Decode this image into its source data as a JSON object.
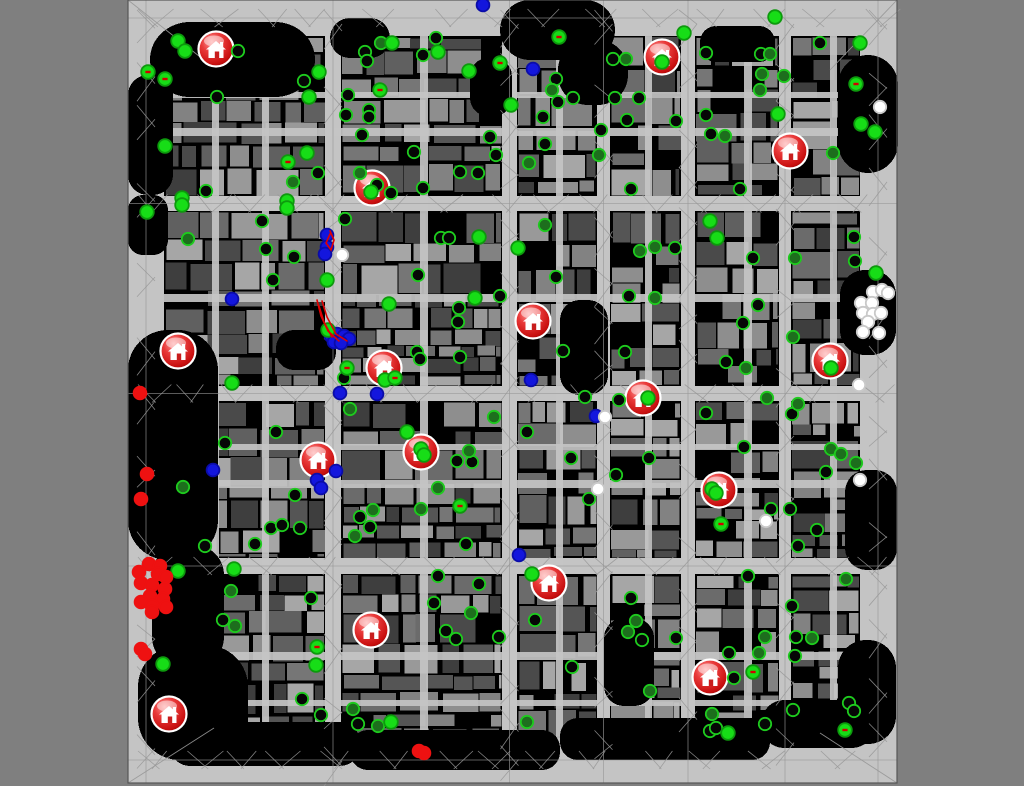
{
  "window": {
    "kind": "rescue-simulation-map-viewer",
    "background_color": "#7f7f7f"
  },
  "map": {
    "x": 128,
    "y": 0,
    "width": 769,
    "height": 783,
    "road_color": "#c4c4c4",
    "mesh_line_color": "#989898",
    "border_line_color": "#565656",
    "block_base_color": "#000000",
    "building_shades": [
      "#3e3e3e",
      "#4a4a4a",
      "#555555",
      "#606060",
      "#6b6b6b",
      "#767676",
      "#828282",
      "#8e8e8e",
      "#999999",
      "#a6a6a6"
    ],
    "seed": 1337,
    "ring": {
      "left_w": 36,
      "right_x": 860,
      "right_w": 37,
      "top_h": 36,
      "bottom_y": 738,
      "bottom_h": 45
    },
    "v_streets": [
      {
        "x": 325,
        "w": 16
      },
      {
        "x": 502,
        "w": 15
      },
      {
        "x": 597,
        "w": 13
      },
      {
        "x": 681,
        "w": 14
      },
      {
        "x": 779,
        "w": 12
      }
    ],
    "h_streets": [
      {
        "y": 196,
        "h": 15
      },
      {
        "y": 386,
        "h": 15
      },
      {
        "y": 558,
        "h": 16
      }
    ],
    "v_lanes": [
      {
        "x": 212,
        "w": 7
      },
      {
        "x": 262,
        "w": 7
      },
      {
        "x": 420,
        "w": 8
      },
      {
        "x": 556,
        "w": 7
      },
      {
        "x": 645,
        "w": 7
      },
      {
        "x": 744,
        "w": 8
      },
      {
        "x": 830,
        "w": 7
      }
    ],
    "h_lanes": [
      {
        "y": 92,
        "h": 6
      },
      {
        "y": 128,
        "h": 8
      },
      {
        "y": 294,
        "h": 8
      },
      {
        "y": 444,
        "h": 6
      },
      {
        "y": 480,
        "h": 8
      },
      {
        "y": 652,
        "h": 8
      },
      {
        "y": 700,
        "h": 6
      }
    ],
    "dark_areas": [
      [
        150,
        22,
        165,
        75,
        40
      ],
      [
        330,
        18,
        60,
        40,
        20
      ],
      [
        500,
        0,
        115,
        60,
        30
      ],
      [
        558,
        40,
        70,
        65,
        30
      ],
      [
        700,
        26,
        75,
        36,
        16
      ],
      [
        838,
        55,
        60,
        118,
        30
      ],
      [
        128,
        75,
        45,
        120,
        20
      ],
      [
        128,
        195,
        40,
        60,
        15
      ],
      [
        128,
        330,
        90,
        230,
        40
      ],
      [
        152,
        545,
        72,
        122,
        30
      ],
      [
        138,
        645,
        110,
        115,
        42
      ],
      [
        170,
        722,
        190,
        44,
        20
      ],
      [
        350,
        730,
        210,
        40,
        18
      ],
      [
        560,
        718,
        210,
        42,
        18
      ],
      [
        762,
        700,
        112,
        48,
        22
      ],
      [
        560,
        300,
        48,
        95,
        20
      ],
      [
        604,
        618,
        50,
        88,
        20
      ],
      [
        840,
        270,
        56,
        85,
        25
      ],
      [
        845,
        470,
        52,
        100,
        22
      ],
      [
        838,
        640,
        58,
        104,
        28
      ],
      [
        470,
        58,
        42,
        58,
        18
      ],
      [
        276,
        330,
        60,
        40,
        18
      ]
    ]
  },
  "legend": {
    "civilian_bright_fill": "#17dd17",
    "civilian_bright_ring": "#0d9a0d",
    "civilian_mid_fill": "#1d6e1d",
    "civilian_dark_fill": "#060606",
    "civilian_ring": "#1ecb1e",
    "police_fill": "#1316dd",
    "police_ring": "#0a0ca8",
    "ambulance_fill": "#ffffff",
    "ambulance_ring": "#c9c9c9",
    "fire_brigade_fill": "#ee1111",
    "refuge_body": "#d42222",
    "refuge_dark": "#7a0000",
    "refuge_glyph": "#ffffff",
    "hose_color": "#e00000",
    "injury_tick_color": "#d40000"
  },
  "entities": {
    "refuges": [
      [
        216,
        49
      ],
      [
        662,
        57
      ],
      [
        790,
        151
      ],
      [
        372,
        188
      ],
      [
        178,
        351
      ],
      [
        533,
        321
      ],
      [
        384,
        368
      ],
      [
        643,
        398
      ],
      [
        830,
        361
      ],
      [
        318,
        460
      ],
      [
        421,
        452
      ],
      [
        719,
        490
      ],
      [
        549,
        583
      ],
      [
        371,
        630
      ],
      [
        710,
        677
      ],
      [
        169,
        714
      ]
    ],
    "civilians_bright": [
      [
        178,
        41
      ],
      [
        185,
        51
      ],
      [
        148,
        72,
        1
      ],
      [
        165,
        79,
        1
      ],
      [
        319,
        72
      ],
      [
        309,
        97
      ],
      [
        380,
        90,
        1
      ],
      [
        392,
        43
      ],
      [
        438,
        52
      ],
      [
        469,
        71
      ],
      [
        500,
        63,
        1
      ],
      [
        511,
        105
      ],
      [
        165,
        146
      ],
      [
        182,
        198
      ],
      [
        182,
        205
      ],
      [
        147,
        212
      ],
      [
        287,
        201
      ],
      [
        287,
        208
      ],
      [
        307,
        153
      ],
      [
        288,
        162,
        1
      ],
      [
        371,
        192
      ],
      [
        327,
        280
      ],
      [
        479,
        237
      ],
      [
        475,
        298
      ],
      [
        389,
        304
      ],
      [
        328,
        330
      ],
      [
        385,
        380
      ],
      [
        395,
        378,
        1
      ],
      [
        232,
        383
      ],
      [
        347,
        368,
        1
      ],
      [
        559,
        37,
        1
      ],
      [
        684,
        33
      ],
      [
        775,
        17
      ],
      [
        662,
        62
      ],
      [
        860,
        43
      ],
      [
        856,
        84,
        1
      ],
      [
        875,
        132
      ],
      [
        861,
        124
      ],
      [
        778,
        114
      ],
      [
        876,
        273
      ],
      [
        518,
        248
      ],
      [
        710,
        221
      ],
      [
        717,
        238
      ],
      [
        831,
        368
      ],
      [
        648,
        398
      ],
      [
        712,
        489
      ],
      [
        716,
        493
      ],
      [
        421,
        449
      ],
      [
        424,
        455
      ],
      [
        532,
        574
      ],
      [
        728,
        733
      ],
      [
        753,
        672,
        1
      ],
      [
        845,
        730,
        1
      ],
      [
        163,
        664
      ],
      [
        178,
        571
      ],
      [
        234,
        569
      ],
      [
        317,
        647,
        1
      ],
      [
        316,
        665
      ],
      [
        391,
        722
      ],
      [
        407,
        432
      ],
      [
        460,
        506,
        1
      ],
      [
        721,
        524,
        1
      ]
    ],
    "civilians_mid": [
      [
        381,
        43
      ],
      [
        293,
        182
      ],
      [
        360,
        173
      ],
      [
        188,
        239
      ],
      [
        552,
        90
      ],
      [
        626,
        59
      ],
      [
        770,
        54
      ],
      [
        762,
        74
      ],
      [
        784,
        76
      ],
      [
        760,
        90
      ],
      [
        599,
        155
      ],
      [
        529,
        163
      ],
      [
        725,
        136
      ],
      [
        833,
        153
      ],
      [
        545,
        225
      ],
      [
        640,
        251
      ],
      [
        655,
        247
      ],
      [
        795,
        258
      ],
      [
        655,
        298
      ],
      [
        793,
        337
      ],
      [
        746,
        368
      ],
      [
        350,
        409
      ],
      [
        494,
        417
      ],
      [
        183,
        487
      ],
      [
        469,
        451
      ],
      [
        438,
        488
      ],
      [
        421,
        509
      ],
      [
        373,
        510
      ],
      [
        355,
        536
      ],
      [
        231,
        591
      ],
      [
        235,
        626
      ],
      [
        353,
        709
      ],
      [
        378,
        726
      ],
      [
        471,
        613
      ],
      [
        767,
        398
      ],
      [
        798,
        404
      ],
      [
        831,
        449
      ],
      [
        841,
        454
      ],
      [
        856,
        463
      ],
      [
        846,
        579
      ],
      [
        636,
        621
      ],
      [
        628,
        632
      ],
      [
        765,
        637
      ],
      [
        812,
        638
      ],
      [
        759,
        653
      ],
      [
        650,
        691
      ],
      [
        527,
        722
      ],
      [
        712,
        714
      ]
    ],
    "civilians_dark": [
      [
        238,
        51
      ],
      [
        304,
        81
      ],
      [
        217,
        97
      ],
      [
        348,
        95
      ],
      [
        365,
        52
      ],
      [
        436,
        38
      ],
      [
        423,
        55
      ],
      [
        367,
        61
      ],
      [
        346,
        115
      ],
      [
        369,
        110
      ],
      [
        369,
        117
      ],
      [
        362,
        135
      ],
      [
        414,
        152
      ],
      [
        490,
        137
      ],
      [
        496,
        155
      ],
      [
        460,
        172
      ],
      [
        478,
        173
      ],
      [
        206,
        191
      ],
      [
        262,
        221
      ],
      [
        318,
        173
      ],
      [
        377,
        185
      ],
      [
        391,
        193
      ],
      [
        423,
        188
      ],
      [
        266,
        249
      ],
      [
        294,
        257
      ],
      [
        273,
        280
      ],
      [
        345,
        219
      ],
      [
        441,
        238
      ],
      [
        449,
        238
      ],
      [
        418,
        275
      ],
      [
        459,
        308
      ],
      [
        458,
        322
      ],
      [
        500,
        296
      ],
      [
        417,
        352
      ],
      [
        460,
        357
      ],
      [
        420,
        359
      ],
      [
        344,
        378
      ],
      [
        556,
        79
      ],
      [
        558,
        102
      ],
      [
        573,
        98
      ],
      [
        615,
        98
      ],
      [
        639,
        98
      ],
      [
        613,
        59
      ],
      [
        706,
        53
      ],
      [
        761,
        54
      ],
      [
        820,
        43
      ],
      [
        543,
        117
      ],
      [
        545,
        144
      ],
      [
        601,
        130
      ],
      [
        627,
        120
      ],
      [
        676,
        121
      ],
      [
        631,
        189
      ],
      [
        740,
        189
      ],
      [
        706,
        115
      ],
      [
        711,
        134
      ],
      [
        675,
        248
      ],
      [
        556,
        277
      ],
      [
        753,
        258
      ],
      [
        854,
        237
      ],
      [
        855,
        261
      ],
      [
        629,
        296
      ],
      [
        758,
        305
      ],
      [
        743,
        323
      ],
      [
        726,
        362
      ],
      [
        563,
        351
      ],
      [
        625,
        352
      ],
      [
        276,
        432
      ],
      [
        225,
        443
      ],
      [
        295,
        495
      ],
      [
        457,
        461
      ],
      [
        472,
        462
      ],
      [
        360,
        517
      ],
      [
        370,
        527
      ],
      [
        271,
        528
      ],
      [
        282,
        525
      ],
      [
        300,
        528
      ],
      [
        255,
        544
      ],
      [
        205,
        546
      ],
      [
        466,
        544
      ],
      [
        223,
        620
      ],
      [
        311,
        598
      ],
      [
        302,
        699
      ],
      [
        321,
        715
      ],
      [
        358,
        724
      ],
      [
        438,
        576
      ],
      [
        479,
        584
      ],
      [
        434,
        603
      ],
      [
        446,
        631
      ],
      [
        456,
        639
      ],
      [
        499,
        637
      ],
      [
        585,
        397
      ],
      [
        619,
        400
      ],
      [
        706,
        413
      ],
      [
        792,
        414
      ],
      [
        527,
        432
      ],
      [
        571,
        458
      ],
      [
        616,
        475
      ],
      [
        649,
        458
      ],
      [
        589,
        499
      ],
      [
        744,
        447
      ],
      [
        826,
        472
      ],
      [
        771,
        509
      ],
      [
        790,
        509
      ],
      [
        817,
        530
      ],
      [
        798,
        546
      ],
      [
        748,
        576
      ],
      [
        631,
        598
      ],
      [
        642,
        640
      ],
      [
        676,
        638
      ],
      [
        535,
        620
      ],
      [
        792,
        606
      ],
      [
        796,
        637
      ],
      [
        729,
        653
      ],
      [
        795,
        656
      ],
      [
        572,
        667
      ],
      [
        734,
        678
      ],
      [
        710,
        731
      ],
      [
        716,
        728
      ],
      [
        765,
        724
      ],
      [
        793,
        710
      ],
      [
        849,
        703
      ],
      [
        854,
        711
      ]
    ],
    "police": [
      [
        483,
        5
      ],
      [
        533,
        69
      ],
      [
        232,
        299
      ],
      [
        327,
        235
      ],
      [
        327,
        247
      ],
      [
        325,
        254
      ],
      [
        213,
        470
      ],
      [
        317,
        480
      ],
      [
        321,
        488
      ],
      [
        336,
        471
      ],
      [
        340,
        393
      ],
      [
        377,
        394
      ],
      [
        531,
        380
      ],
      [
        519,
        555
      ],
      [
        596,
        416
      ],
      [
        331,
        336
      ],
      [
        337,
        334
      ],
      [
        344,
        336
      ],
      [
        349,
        339
      ],
      [
        334,
        342
      ],
      [
        341,
        343
      ]
    ],
    "ambulances": [
      [
        342,
        255
      ],
      [
        605,
        417
      ],
      [
        598,
        489
      ],
      [
        766,
        521
      ],
      [
        860,
        480
      ],
      [
        880,
        107
      ],
      [
        873,
        292
      ],
      [
        882,
        290
      ],
      [
        888,
        293
      ],
      [
        861,
        303
      ],
      [
        872,
        303
      ],
      [
        863,
        313
      ],
      [
        873,
        314
      ],
      [
        881,
        313
      ],
      [
        868,
        322
      ],
      [
        863,
        332
      ],
      [
        879,
        333
      ],
      [
        859,
        385
      ]
    ],
    "fire_brigades": [
      [
        140,
        393
      ],
      [
        147,
        474
      ],
      [
        141,
        499
      ],
      [
        141,
        649
      ],
      [
        145,
        654
      ],
      [
        149,
        564
      ],
      [
        160,
        566
      ],
      [
        139,
        572
      ],
      [
        158,
        574
      ],
      [
        166,
        577
      ],
      [
        141,
        583
      ],
      [
        152,
        585
      ],
      [
        165,
        589
      ],
      [
        150,
        596
      ],
      [
        163,
        599
      ],
      [
        141,
        602
      ],
      [
        152,
        606
      ],
      [
        166,
        607
      ],
      [
        152,
        612
      ],
      [
        419,
        751
      ],
      [
        424,
        753
      ]
    ],
    "hose_lines": [
      [
        [
          317,
          300
        ],
        [
          321,
          316
        ],
        [
          328,
          331
        ],
        [
          339,
          341
        ]
      ],
      [
        [
          322,
          301
        ],
        [
          327,
          317
        ],
        [
          336,
          334
        ],
        [
          347,
          341
        ]
      ],
      [
        [
          319,
          306
        ],
        [
          324,
          322
        ],
        [
          332,
          337
        ]
      ],
      [
        [
          330,
          231
        ],
        [
          334,
          240
        ],
        [
          331,
          250
        ],
        [
          326,
          243
        ],
        [
          330,
          234
        ]
      ]
    ]
  }
}
